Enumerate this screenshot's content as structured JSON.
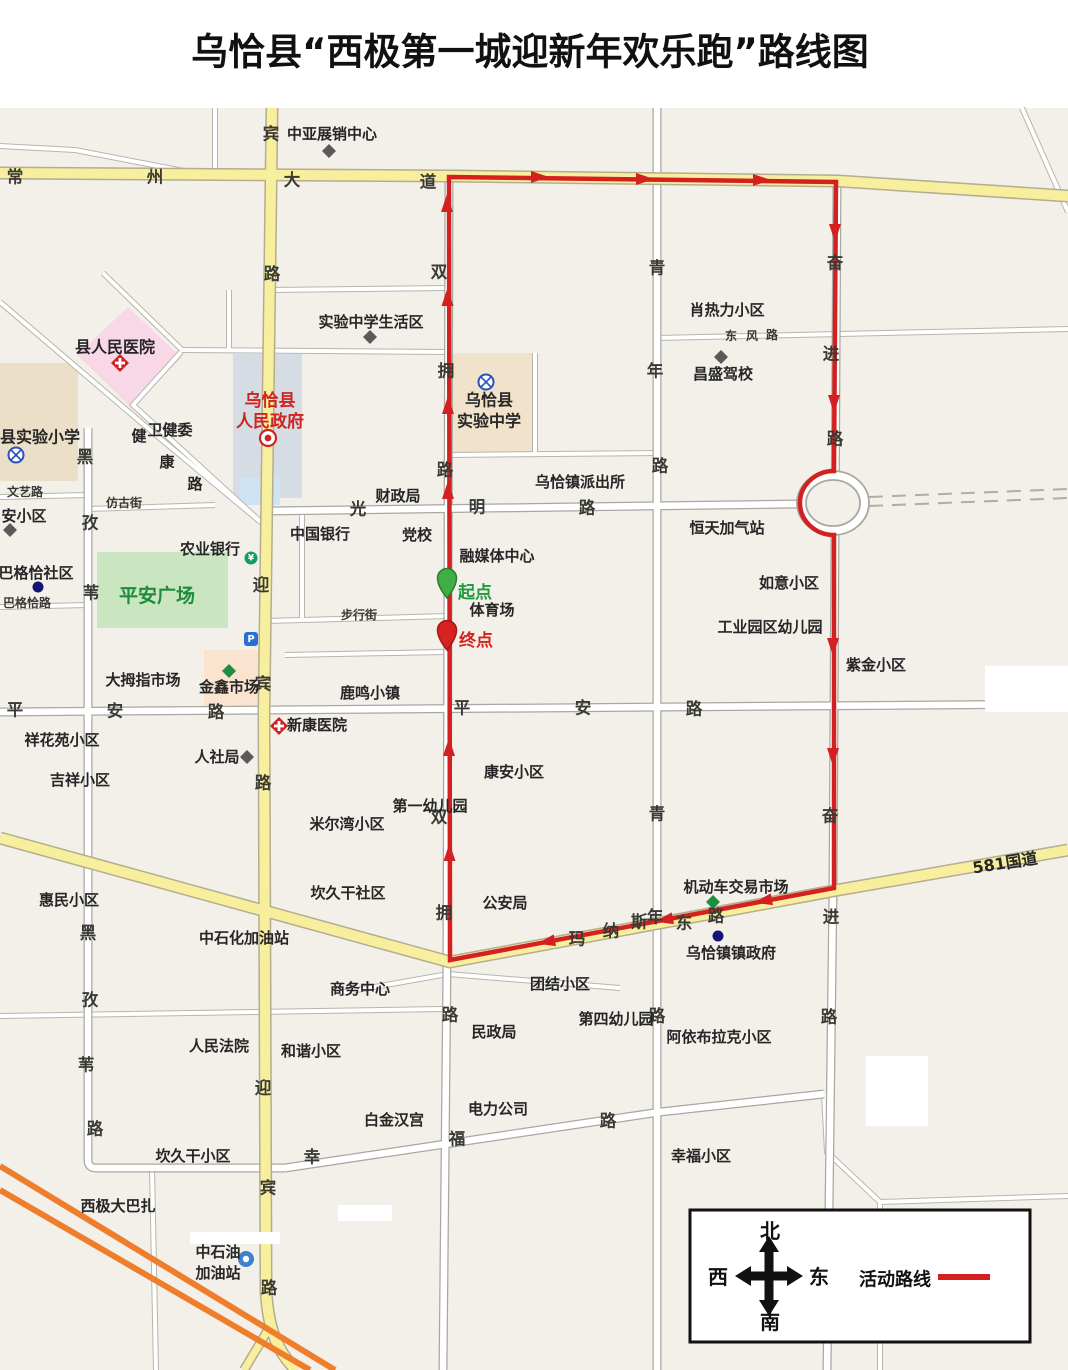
{
  "title": "乌恰县“西极第一城迎新年欢乐跑”路线图",
  "legend": {
    "route_label": "活动路线",
    "north": "北",
    "south": "南",
    "east": "东",
    "west": "西"
  },
  "route": {
    "start": "起点",
    "end": "终点"
  },
  "colors": {
    "route_red": "#d42020",
    "start_green": "#2fa63f",
    "yellow_road": "#f8ef9e",
    "green_area": "#c9e6c0",
    "gov_text": "#d0241f"
  },
  "icons": {
    "bank_glyph": "¥",
    "parking_glyph": "P"
  },
  "roads": {
    "changzhou": [
      "常",
      "州",
      "大",
      "道"
    ],
    "yingbin": [
      "迎",
      "宾",
      "路"
    ],
    "shuangyong": [
      "双",
      "拥",
      "路"
    ],
    "qingnian": [
      "青",
      "年",
      "路"
    ],
    "fenjin": [
      "奋",
      "进",
      "路"
    ],
    "heiziwei": [
      "黑",
      "孜",
      "苇",
      "路"
    ],
    "guangming": [
      "光",
      "明",
      "路"
    ],
    "pingan": [
      "平",
      "安",
      "路"
    ],
    "dongfeng": [
      "东",
      "风",
      "路"
    ],
    "manas": [
      "玛",
      "纳",
      "斯",
      "东",
      "路"
    ],
    "xingfu": [
      "幸",
      "福",
      "路"
    ],
    "jiankang": [
      "健",
      "康",
      "路"
    ],
    "g581": "581国道",
    "streets": {
      "fanggu": "仿古街",
      "buxing": "步行街",
      "wenyi": "文艺路",
      "bagecha": "巴格恰路"
    }
  },
  "places": {
    "zhongya": "中亚展销中心",
    "shiyan_shenghuo": "实验中学生活区",
    "renmin_yiyuan": "县人民医院",
    "gov1": "乌恰县",
    "gov2": "人民政府",
    "shiyan_xiaoxue": "县实验小学",
    "weijianwei": "卫健委",
    "shiyan_zx1": "乌恰县",
    "shiyan_zx2": "实验中学",
    "xiaoreli": "肖热力小区",
    "changsheng": "昌盛驾校",
    "paichusuo": "乌恰镇派出所",
    "caizhengju": "财政局",
    "dangxiao": "党校",
    "zhongguo_yh": "中国银行",
    "nongye_yh": "农业银行",
    "rongmeiti": "融媒体中心",
    "hengtian": "恒天加气站",
    "pingan_gc": "平安广场",
    "tiyuchang": "体育场",
    "anxiaoqu": "安小区",
    "bagecha_sq": "巴格恰社区",
    "damuzhi": "大拇指市场",
    "jinxin": "金鑫市场",
    "luming": "鹿鸣小镇",
    "xinkang": "新康医院",
    "rensheju": "人社局",
    "xianghuayuan": "祥花苑小区",
    "jixiang": "吉祥小区",
    "huimin": "惠民小区",
    "zhongshihua": "中石化加油站",
    "mierwan": "米尔湾小区",
    "kanjiugan_sq": "坎久干社区",
    "diyi_yey": "第一幼儿园",
    "kangan": "康安小区",
    "gonganju": "公安局",
    "shangwu": "商务中心",
    "ruyi": "如意小区",
    "gongyeyuan": "工业园区幼儿园",
    "zijin": "紫金小区",
    "jidongche": "机动车交易市场",
    "zhenzhengfu": "乌恰镇镇政府",
    "tuanjie": "团结小区",
    "renmin_fy": "人民法院",
    "hexie": "和谐小区",
    "minzhengju": "民政局",
    "baijin": "白金汉宫",
    "dianli": "电力公司",
    "kanjiugan_xq": "坎久干小区",
    "xiji": "西极大巴扎",
    "zsy1": "中石油",
    "zsy2": "加油站",
    "disi_yey": "第四幼儿园",
    "ayibulake": "阿依布拉克小区",
    "xingfu_xq": "幸福小区"
  }
}
